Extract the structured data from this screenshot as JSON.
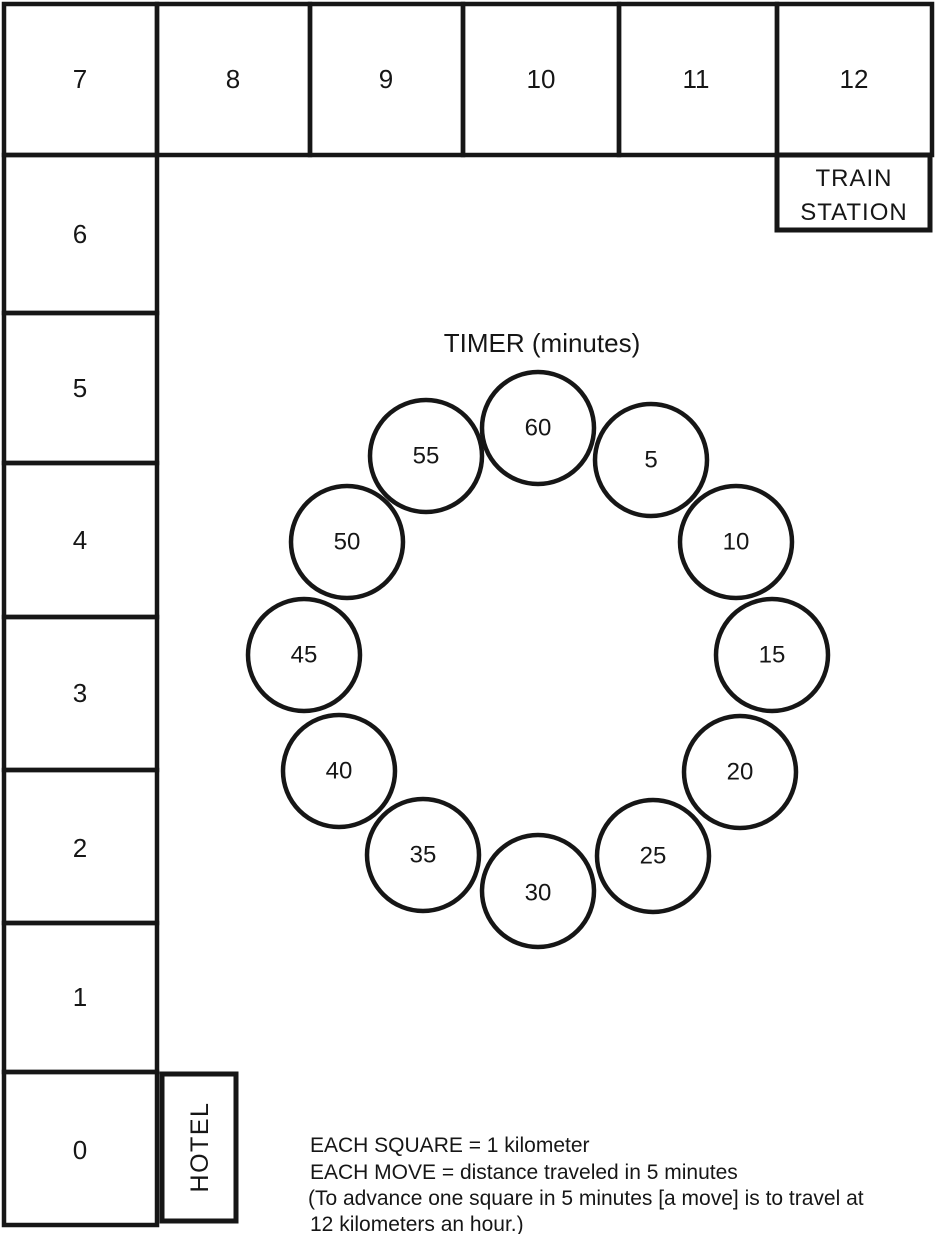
{
  "figure": {
    "description": "Scanned game-board figure with distance track, timer clock and legend",
    "ink_color": "#161616",
    "background_color": "#ffffff"
  },
  "board": {
    "top_row": [
      "7",
      "8",
      "9",
      "10",
      "11",
      "12"
    ],
    "left_column": [
      "6",
      "5",
      "4",
      "3",
      "2",
      "1",
      "0"
    ],
    "train_station": {
      "line1": "TRAIN",
      "line2": "STATION"
    },
    "hotel_label": "HOTEL"
  },
  "timer": {
    "title": "TIMER (minutes)",
    "values": [
      "60",
      "5",
      "10",
      "15",
      "20",
      "25",
      "30",
      "35",
      "40",
      "45",
      "50",
      "55"
    ]
  },
  "legend": {
    "lines": [
      "EACH SQUARE = 1 kilometer",
      "EACH MOVE = distance traveled in 5 minutes",
      "(To advance one square in 5 minutes [a move] is to travel at",
      "12 kilometers an hour.)"
    ]
  }
}
